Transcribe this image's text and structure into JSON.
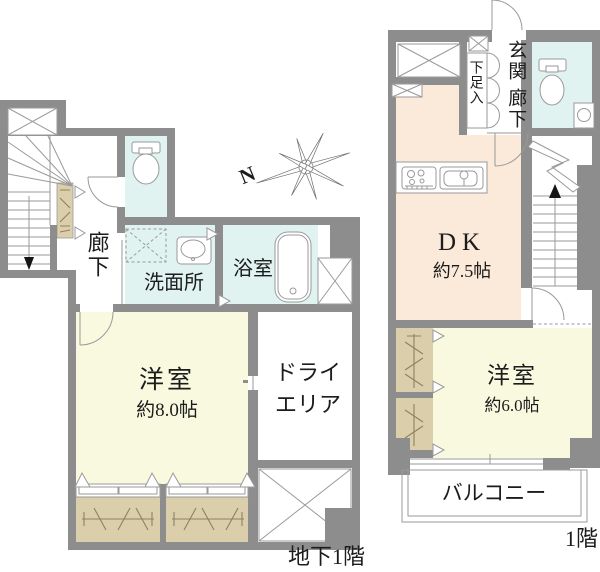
{
  "colors": {
    "wall": "#8d8d8d",
    "water_room": "#e0f3f1",
    "bedroom": "#f9f9e0",
    "dk": "#fbe9d9",
    "closet": "#dbceab",
    "line": "#9a9a9a",
    "hatch": "#8c8162",
    "text": "#1c1c1c"
  },
  "compass": {
    "north_label": "N"
  },
  "basement_plan": {
    "floor_label": "地下1階",
    "corridor": "廊下",
    "washroom": "洗面所",
    "bath": "浴室",
    "bedroom": "洋室",
    "bedroom_size": "約8.0帖",
    "dry_area_line1": "ドライ",
    "dry_area_line2": "エリア"
  },
  "first_floor_plan": {
    "floor_label": "1階",
    "entrance": "玄関",
    "corridor": "廊下",
    "shoe_cabinet": "下足入",
    "dk": "DK",
    "dk_size": "約7.5帖",
    "bedroom": "洋室",
    "bedroom_size": "約6.0帖",
    "balcony": "バルコニー"
  }
}
